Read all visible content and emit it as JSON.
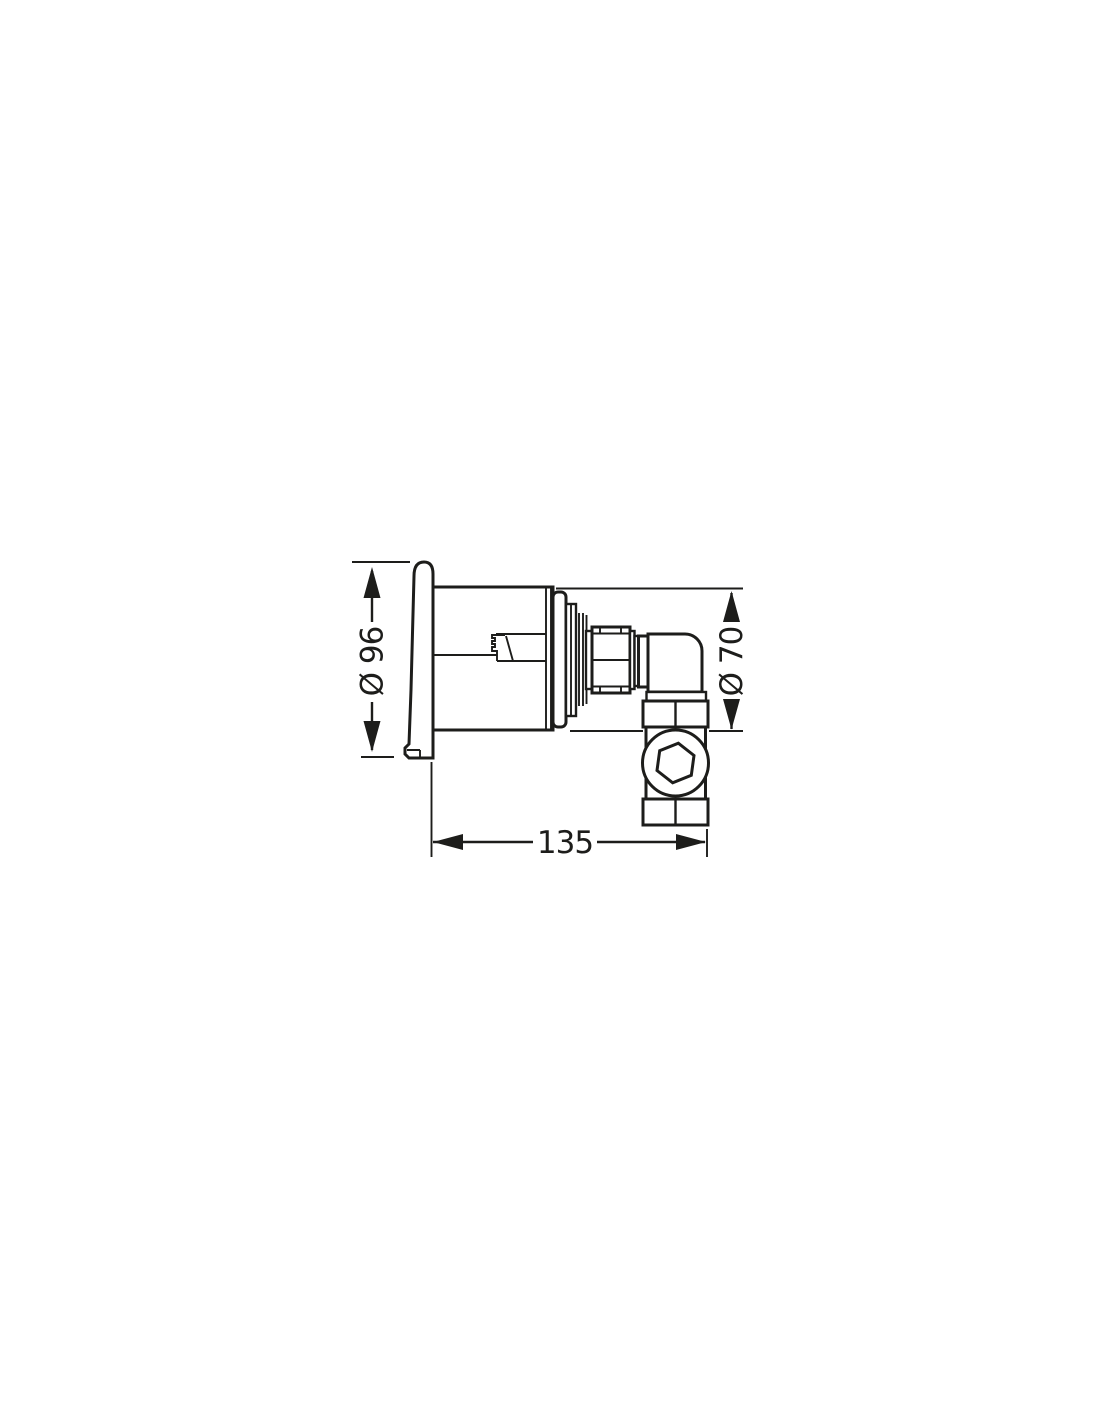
{
  "drawing": {
    "background_color": "#ffffff",
    "line_color": "#1d1d1b",
    "dimensions": {
      "escutcheon_diameter": {
        "label": "Ø 96",
        "value": 96
      },
      "body_diameter": {
        "label": "Ø 70",
        "value": 70
      },
      "depth": {
        "label": "135",
        "value": 135
      }
    }
  }
}
